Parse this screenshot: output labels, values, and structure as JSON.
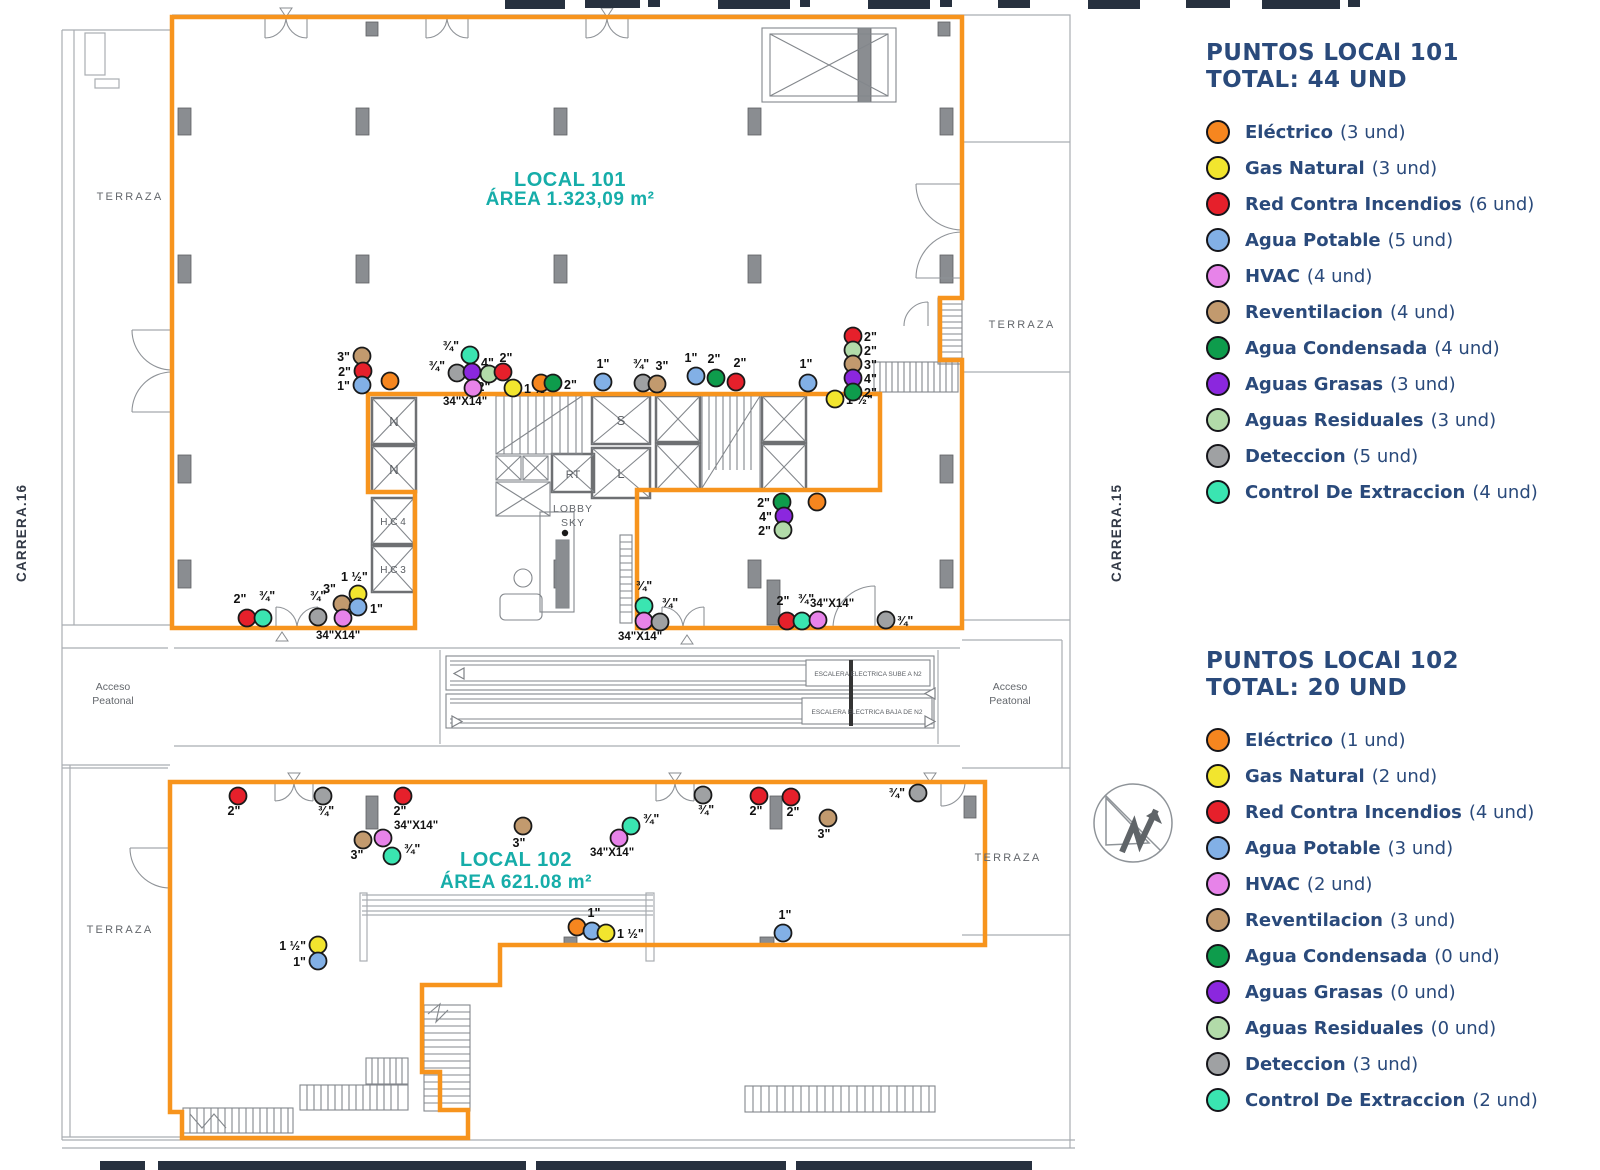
{
  "colors": {
    "electrico": "#F6861F",
    "gas": "#F2E52E",
    "rci": "#E6202B",
    "agua": "#82B0E6",
    "hvac": "#E783E9",
    "revent": "#C29A6E",
    "condensada": "#0E9C4C",
    "grasas": "#8B27DE",
    "residuales": "#B2DBA9",
    "deteccion": "#9FA1A3",
    "extraccion": "#3AE5B1",
    "outline": "#F7941D",
    "teal": "#16ADA9",
    "navy": "#2A4A7B"
  },
  "legends": [
    {
      "title": "PUNTOS LOCAl 101",
      "total": "TOTAL: 44 UND",
      "items": [
        {
          "key": "electrico",
          "name": "Eléctrico",
          "count": "(3 und)"
        },
        {
          "key": "gas",
          "name": "Gas Natural",
          "count": "(3 und)"
        },
        {
          "key": "rci",
          "name": "Red Contra Incendios",
          "count": "(6 und)"
        },
        {
          "key": "agua",
          "name": "Agua Potable",
          "count": "(5 und)"
        },
        {
          "key": "hvac",
          "name": "HVAC",
          "count": "(4 und)"
        },
        {
          "key": "revent",
          "name": "Reventilacion",
          "count": "(4 und)"
        },
        {
          "key": "condensada",
          "name": "Agua Condensada",
          "count": "(4 und)"
        },
        {
          "key": "grasas",
          "name": "Aguas Grasas",
          "count": "(3 und)"
        },
        {
          "key": "residuales",
          "name": "Aguas Residuales",
          "count": "(3 und)"
        },
        {
          "key": "deteccion",
          "name": "Deteccion",
          "count": "(5 und)"
        },
        {
          "key": "extraccion",
          "name": "Control De Extraccion",
          "count": "(4 und)"
        }
      ]
    },
    {
      "title": "PUNTOS LOCAl 102",
      "total": "TOTAL: 20 UND",
      "items": [
        {
          "key": "electrico",
          "name": "Eléctrico",
          "count": "(1 und)"
        },
        {
          "key": "gas",
          "name": "Gas Natural",
          "count": "(2 und)"
        },
        {
          "key": "rci",
          "name": "Red Contra Incendios",
          "count": "(4 und)"
        },
        {
          "key": "agua",
          "name": "Agua Potable",
          "count": "(3 und)"
        },
        {
          "key": "hvac",
          "name": "HVAC",
          "count": "(2 und)"
        },
        {
          "key": "revent",
          "name": "Reventilacion",
          "count": "(3 und)"
        },
        {
          "key": "condensada",
          "name": "Agua Condensada",
          "count": "(0 und)"
        },
        {
          "key": "grasas",
          "name": "Aguas Grasas",
          "count": "(0 und)"
        },
        {
          "key": "residuales",
          "name": "Aguas Residuales",
          "count": "(0 und)"
        },
        {
          "key": "deteccion",
          "name": "Deteccion",
          "count": "(3 und)"
        },
        {
          "key": "extraccion",
          "name": "Control De Extraccion",
          "count": "(2 und)"
        }
      ]
    }
  ],
  "plan": {
    "local101": {
      "name": "LOCAL 101",
      "area": "ÁREA 1.323,09 m²"
    },
    "local102": {
      "name": "LOCAL 102",
      "area": "ÁREA 621.08 m²"
    },
    "duct_label": "34\"X14\"",
    "labels": {
      "terraza": "TERRAZA",
      "acceso": "Acceso",
      "peatonal": "Peatonal",
      "carrera16": "CARRERA.16",
      "carrera15": "CARRERA.15",
      "lobby": "LOBBY",
      "sky": "SKY",
      "esc_sube": "ESCALERA ELECTRICA SUBE A N2",
      "esc_baja": "ESCALERA ELECTRICA BAJA DE N2",
      "n": "N",
      "hc4": "H.C 4",
      "hc3": "H.C 3",
      "s": "S",
      "l": "L",
      "rt": "RT"
    },
    "points_101": [
      {
        "k": "revent",
        "x": 362,
        "y": 356,
        "t": "3\"",
        "tx": 350,
        "ty": 361,
        "a": "e"
      },
      {
        "k": "rci",
        "x": 363,
        "y": 371,
        "t": "2\"",
        "tx": 351,
        "ty": 376,
        "a": "e"
      },
      {
        "k": "agua",
        "x": 362,
        "y": 385,
        "t": "1\"",
        "tx": 350,
        "ty": 390,
        "a": "e"
      },
      {
        "k": "electrico",
        "x": 390,
        "y": 381
      },
      {
        "k": "extraccion",
        "x": 470,
        "y": 355,
        "t": "¾\"",
        "tx": 459,
        "ty": 350,
        "a": "e"
      },
      {
        "k": "deteccion",
        "x": 457,
        "y": 373,
        "t": "¾\"",
        "tx": 445,
        "ty": 370,
        "a": "e"
      },
      {
        "k": "grasas",
        "x": 472,
        "y": 372,
        "t": "4\"",
        "tx": 481,
        "ty": 367,
        "a": "s"
      },
      {
        "k": "residuales",
        "x": 489,
        "y": 374,
        "t": "2\"",
        "tx": 484,
        "ty": 391,
        "a": "m"
      },
      {
        "k": "rci",
        "x": 503,
        "y": 372,
        "t": "2\"",
        "tx": 506,
        "ty": 362,
        "a": "m"
      },
      {
        "k": "hvac",
        "x": 473,
        "y": 388
      },
      {
        "k": "gas",
        "x": 513,
        "y": 388,
        "t": "1 ½\"",
        "tx": 524,
        "ty": 393,
        "a": "s"
      },
      {
        "k": "electrico",
        "x": 541,
        "y": 383
      },
      {
        "k": "condensada",
        "x": 553,
        "y": 383,
        "t": "2\"",
        "tx": 564,
        "ty": 389,
        "a": "s"
      },
      {
        "k": "agua",
        "x": 603,
        "y": 382,
        "t": "1\"",
        "tx": 603,
        "ty": 368,
        "a": "m"
      },
      {
        "k": "deteccion",
        "x": 643,
        "y": 383,
        "t": "¾\"",
        "tx": 641,
        "ty": 368,
        "a": "m"
      },
      {
        "k": "revent",
        "x": 657,
        "y": 384,
        "t": "3\"",
        "tx": 662,
        "ty": 370,
        "a": "m"
      },
      {
        "k": "agua",
        "x": 696,
        "y": 376,
        "t": "1\"",
        "tx": 691,
        "ty": 362,
        "a": "m"
      },
      {
        "k": "condensada",
        "x": 716,
        "y": 378,
        "t": "2\"",
        "tx": 714,
        "ty": 363,
        "a": "m"
      },
      {
        "k": "rci",
        "x": 736,
        "y": 382,
        "t": "2\"",
        "tx": 740,
        "ty": 367,
        "a": "m"
      },
      {
        "k": "agua",
        "x": 808,
        "y": 383,
        "t": "1\"",
        "tx": 806,
        "ty": 368,
        "a": "m"
      },
      {
        "k": "gas",
        "x": 835,
        "y": 399,
        "t": "1 ½\"",
        "tx": 846,
        "ty": 404,
        "a": "s"
      },
      {
        "k": "rci",
        "x": 853,
        "y": 336,
        "t": "2\"",
        "tx": 864,
        "ty": 341,
        "a": "s"
      },
      {
        "k": "residuales",
        "x": 853,
        "y": 350,
        "t": "2\"",
        "tx": 864,
        "ty": 355,
        "a": "s"
      },
      {
        "k": "revent",
        "x": 853,
        "y": 364,
        "t": "3\"",
        "tx": 864,
        "ty": 369,
        "a": "s"
      },
      {
        "k": "grasas",
        "x": 853,
        "y": 378,
        "t": "4\"",
        "tx": 864,
        "ty": 383,
        "a": "s"
      },
      {
        "k": "condensada",
        "x": 853,
        "y": 392,
        "t": "2\"",
        "tx": 864,
        "ty": 397,
        "a": "s"
      },
      {
        "k": "condensada",
        "x": 782,
        "y": 502,
        "t": "2\"",
        "tx": 770,
        "ty": 507,
        "a": "e"
      },
      {
        "k": "electrico",
        "x": 817,
        "y": 502
      },
      {
        "k": "grasas",
        "x": 784,
        "y": 516,
        "t": "4\"",
        "tx": 772,
        "ty": 521,
        "a": "e"
      },
      {
        "k": "residuales",
        "x": 783,
        "y": 530,
        "t": "2\"",
        "tx": 771,
        "ty": 535,
        "a": "e"
      },
      {
        "k": "rci",
        "x": 247,
        "y": 618,
        "t": "2\"",
        "tx": 240,
        "ty": 603,
        "a": "m"
      },
      {
        "k": "extraccion",
        "x": 263,
        "y": 618,
        "t": "¾\"",
        "tx": 267,
        "ty": 600,
        "a": "m"
      },
      {
        "k": "deteccion",
        "x": 318,
        "y": 617,
        "t": "¾\"",
        "tx": 318,
        "ty": 600,
        "a": "m"
      },
      {
        "k": "revent",
        "x": 342,
        "y": 604,
        "t": "3\"",
        "tx": 336,
        "ty": 593,
        "a": "e"
      },
      {
        "k": "gas",
        "x": 358,
        "y": 594,
        "t": "1 ½\"",
        "tx": 341,
        "ty": 581,
        "a": "s"
      },
      {
        "k": "agua",
        "x": 358,
        "y": 607,
        "t": "1\"",
        "tx": 370,
        "ty": 613,
        "a": "s"
      },
      {
        "k": "hvac",
        "x": 343,
        "y": 618
      },
      {
        "k": "extraccion",
        "x": 644,
        "y": 606,
        "t": "¾\"",
        "tx": 644,
        "ty": 590,
        "a": "m"
      },
      {
        "k": "hvac",
        "x": 644,
        "y": 621
      },
      {
        "k": "deteccion",
        "x": 660,
        "y": 622,
        "t": "¾\"",
        "tx": 670,
        "ty": 607,
        "a": "m"
      },
      {
        "k": "rci",
        "x": 787,
        "y": 621,
        "t": "2\"",
        "tx": 783,
        "ty": 605,
        "a": "m"
      },
      {
        "k": "extraccion",
        "x": 802,
        "y": 621,
        "t": "¾\"",
        "tx": 806,
        "ty": 603,
        "a": "m"
      },
      {
        "k": "hvac",
        "x": 818,
        "y": 620
      },
      {
        "k": "deteccion",
        "x": 886,
        "y": 620,
        "t": "¾\"",
        "tx": 897,
        "ty": 625,
        "a": "s"
      }
    ],
    "duct_labels_101": [
      {
        "x": 443,
        "y": 405
      },
      {
        "x": 316,
        "y": 639
      },
      {
        "x": 618,
        "y": 640
      },
      {
        "x": 810,
        "y": 607
      }
    ],
    "points_102": [
      {
        "k": "rci",
        "x": 238,
        "y": 796,
        "t": "2\"",
        "tx": 234,
        "ty": 815,
        "a": "m"
      },
      {
        "k": "deteccion",
        "x": 323,
        "y": 796,
        "t": "¾\"",
        "tx": 326,
        "ty": 815,
        "a": "m"
      },
      {
        "k": "rci",
        "x": 403,
        "y": 796,
        "t": "2\"",
        "tx": 400,
        "ty": 815,
        "a": "m"
      },
      {
        "k": "revent",
        "x": 363,
        "y": 840,
        "t": "3\"",
        "tx": 357,
        "ty": 859,
        "a": "m"
      },
      {
        "k": "hvac",
        "x": 383,
        "y": 838
      },
      {
        "k": "extraccion",
        "x": 392,
        "y": 856,
        "t": "¾\"",
        "tx": 404,
        "ty": 853,
        "a": "s"
      },
      {
        "k": "revent",
        "x": 523,
        "y": 826,
        "t": "3\"",
        "tx": 519,
        "ty": 847,
        "a": "m"
      },
      {
        "k": "deteccion",
        "x": 703,
        "y": 795,
        "t": "¾\"",
        "tx": 706,
        "ty": 814,
        "a": "m"
      },
      {
        "k": "rci",
        "x": 759,
        "y": 796,
        "t": "2\"",
        "tx": 756,
        "ty": 815,
        "a": "m"
      },
      {
        "k": "rci",
        "x": 791,
        "y": 797,
        "t": "2\"",
        "tx": 793,
        "ty": 816,
        "a": "m"
      },
      {
        "k": "revent",
        "x": 828,
        "y": 818,
        "t": "3\"",
        "tx": 824,
        "ty": 838,
        "a": "m"
      },
      {
        "k": "deteccion",
        "x": 918,
        "y": 793,
        "t": "¾\"",
        "tx": 905,
        "ty": 797,
        "a": "e"
      },
      {
        "k": "extraccion",
        "x": 631,
        "y": 826,
        "t": "¾\"",
        "tx": 643,
        "ty": 823,
        "a": "s"
      },
      {
        "k": "hvac",
        "x": 619,
        "y": 838
      },
      {
        "k": "gas",
        "x": 318,
        "y": 945,
        "t": "1 ½\"",
        "tx": 306,
        "ty": 950,
        "a": "e"
      },
      {
        "k": "agua",
        "x": 318,
        "y": 961,
        "t": "1\"",
        "tx": 306,
        "ty": 966,
        "a": "e"
      },
      {
        "k": "electrico",
        "x": 577,
        "y": 927
      },
      {
        "k": "agua",
        "x": 592,
        "y": 931,
        "t": "1\"",
        "tx": 594,
        "ty": 917,
        "a": "m"
      },
      {
        "k": "gas",
        "x": 606,
        "y": 933,
        "t": "1 ½\"",
        "tx": 617,
        "ty": 938,
        "a": "s"
      },
      {
        "k": "agua",
        "x": 783,
        "y": 933,
        "t": "1\"",
        "tx": 785,
        "ty": 919,
        "a": "m"
      }
    ],
    "duct_labels_102": [
      {
        "x": 394,
        "y": 829
      },
      {
        "x": 590,
        "y": 856
      }
    ]
  }
}
